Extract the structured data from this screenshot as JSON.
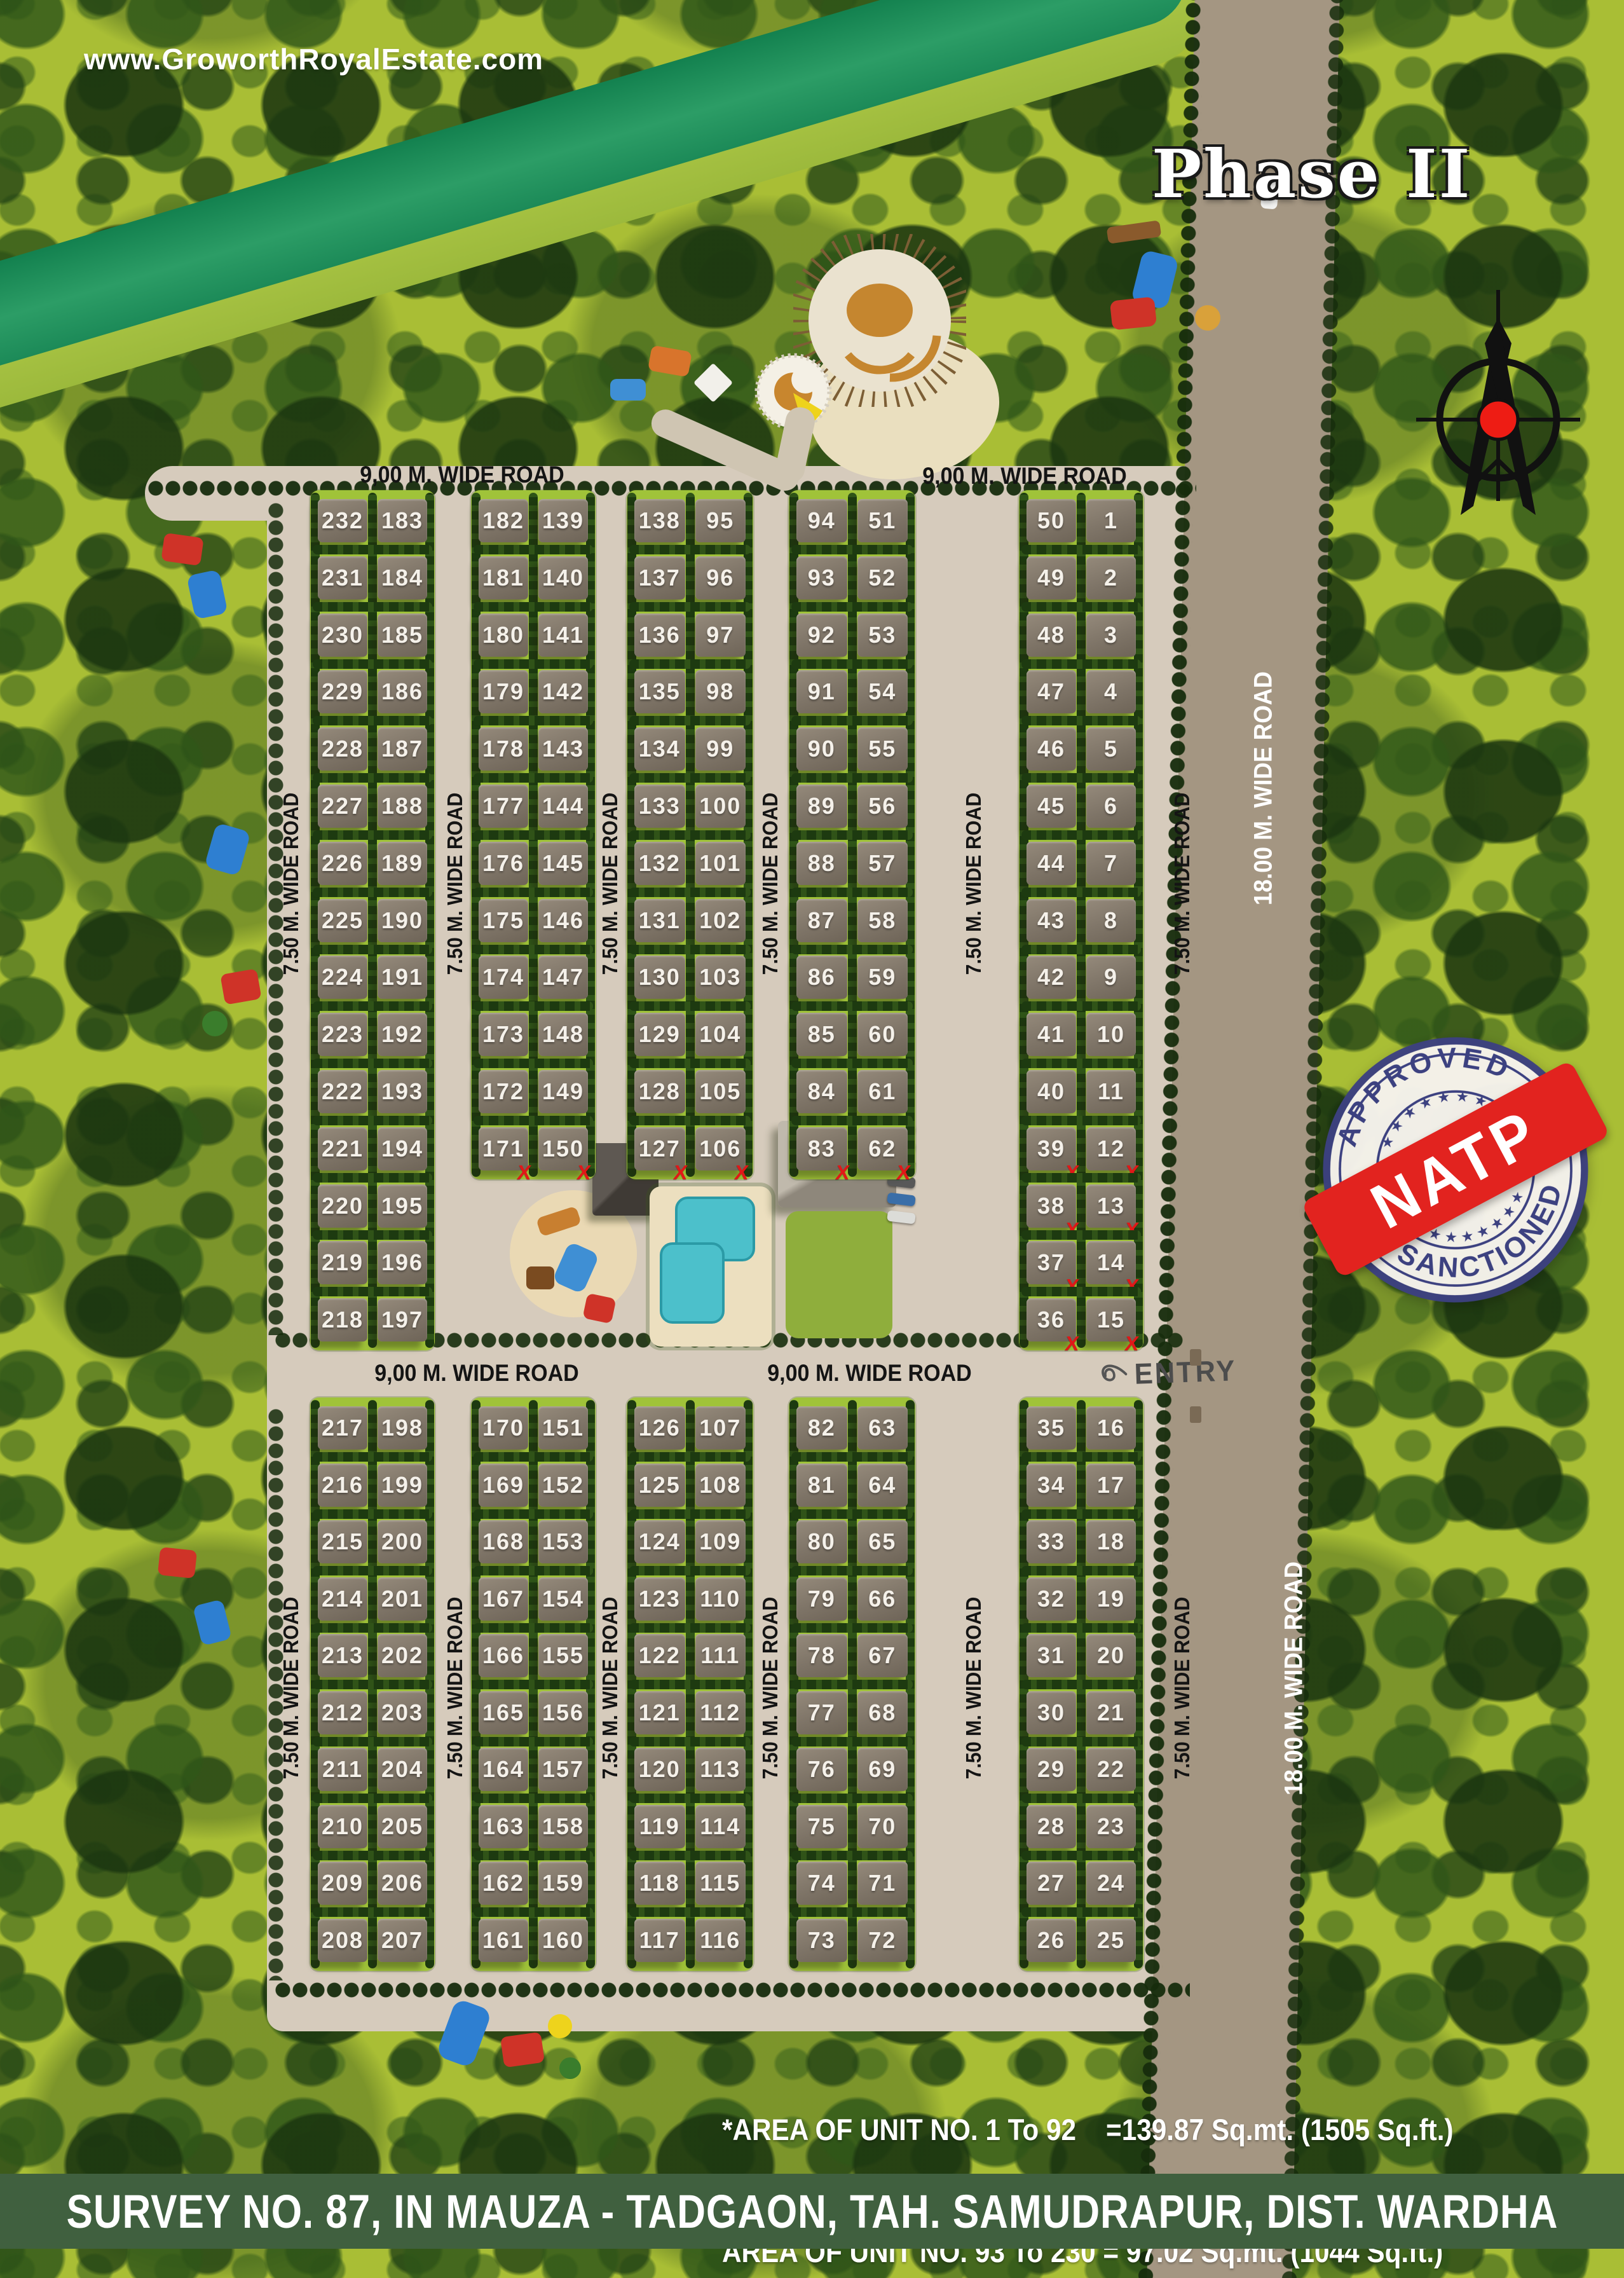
{
  "site": {
    "url": "www.GroworthRoyalEstate.com",
    "phase_title": "Phase II",
    "entry_label": "ENTRY"
  },
  "roads": {
    "w900": "9,00 M. WIDE ROAD",
    "w750": "7.50 M. WIDE ROAD",
    "w1800": "18.00 M. WIDE ROAD"
  },
  "stamp": {
    "top": "APPROVED",
    "bottom": "SANCTIONED",
    "ribbon": "NATP",
    "stars_top": "★ ★ ★ ★ ★ ★ ★",
    "stars_bottom": "★ ★ ★ ★ ★ ★ ★",
    "ring_color": "#3c4180",
    "ribbon_color": "#e2231f"
  },
  "notes": {
    "line1": "*AREA OF UNIT NO. 1 To 92    =139.87 Sq.mt. (1505 Sq.ft.)",
    "line2": "AREA OF UNIT NO. 93 To 230 = 97.02 Sq.mt. (1044 Sq.ft.)"
  },
  "footer": "SURVEY NO. 87, IN MAUZA - TADGAON, TAH. SAMUDRAPUR, DIST. WARDHA",
  "layout": {
    "sold": [
      "171",
      "150",
      "127",
      "106",
      "83",
      "62",
      "39",
      "12",
      "38",
      "13",
      "37",
      "14",
      "36",
      "15"
    ],
    "blocks": [
      {
        "id": "U1",
        "section": "upper",
        "col": 0,
        "rows": [
          [
            "232",
            "183"
          ],
          [
            "231",
            "184"
          ],
          [
            "230",
            "185"
          ],
          [
            "229",
            "186"
          ],
          [
            "228",
            "187"
          ],
          [
            "227",
            "188"
          ],
          [
            "226",
            "189"
          ],
          [
            "225",
            "190"
          ],
          [
            "224",
            "191"
          ],
          [
            "223",
            "192"
          ],
          [
            "222",
            "193"
          ],
          [
            "221",
            "194"
          ],
          [
            "220",
            "195"
          ],
          [
            "219",
            "196"
          ],
          [
            "218",
            "197"
          ]
        ]
      },
      {
        "id": "U2",
        "section": "upper",
        "col": 1,
        "rows": [
          [
            "182",
            "139"
          ],
          [
            "181",
            "140"
          ],
          [
            "180",
            "141"
          ],
          [
            "179",
            "142"
          ],
          [
            "178",
            "143"
          ],
          [
            "177",
            "144"
          ],
          [
            "176",
            "145"
          ],
          [
            "175",
            "146"
          ],
          [
            "174",
            "147"
          ],
          [
            "173",
            "148"
          ],
          [
            "172",
            "149"
          ],
          [
            "171",
            "150"
          ]
        ]
      },
      {
        "id": "U3",
        "section": "upper",
        "col": 2,
        "rows": [
          [
            "138",
            "95"
          ],
          [
            "137",
            "96"
          ],
          [
            "136",
            "97"
          ],
          [
            "135",
            "98"
          ],
          [
            "134",
            "99"
          ],
          [
            "133",
            "100"
          ],
          [
            "132",
            "101"
          ],
          [
            "131",
            "102"
          ],
          [
            "130",
            "103"
          ],
          [
            "129",
            "104"
          ],
          [
            "128",
            "105"
          ],
          [
            "127",
            "106"
          ]
        ]
      },
      {
        "id": "U4",
        "section": "upper",
        "col": 3,
        "rows": [
          [
            "94",
            "51"
          ],
          [
            "93",
            "52"
          ],
          [
            "92",
            "53"
          ],
          [
            "91",
            "54"
          ],
          [
            "90",
            "55"
          ],
          [
            "89",
            "56"
          ],
          [
            "88",
            "57"
          ],
          [
            "87",
            "58"
          ],
          [
            "86",
            "59"
          ],
          [
            "85",
            "60"
          ],
          [
            "84",
            "61"
          ],
          [
            "83",
            "62"
          ]
        ]
      },
      {
        "id": "U5",
        "section": "upper",
        "col": 4,
        "rows": [
          [
            "50",
            "1"
          ],
          [
            "49",
            "2"
          ],
          [
            "48",
            "3"
          ],
          [
            "47",
            "4"
          ],
          [
            "46",
            "5"
          ],
          [
            "45",
            "6"
          ],
          [
            "44",
            "7"
          ],
          [
            "43",
            "8"
          ],
          [
            "42",
            "9"
          ],
          [
            "41",
            "10"
          ],
          [
            "40",
            "11"
          ],
          [
            "39",
            "12"
          ],
          [
            "38",
            "13"
          ],
          [
            "37",
            "14"
          ],
          [
            "36",
            "15"
          ]
        ]
      },
      {
        "id": "L1",
        "section": "lower",
        "col": 0,
        "rows": [
          [
            "217",
            "198"
          ],
          [
            "216",
            "199"
          ],
          [
            "215",
            "200"
          ],
          [
            "214",
            "201"
          ],
          [
            "213",
            "202"
          ],
          [
            "212",
            "203"
          ],
          [
            "211",
            "204"
          ],
          [
            "210",
            "205"
          ],
          [
            "209",
            "206"
          ],
          [
            "208",
            "207"
          ]
        ]
      },
      {
        "id": "L2",
        "section": "lower",
        "col": 1,
        "rows": [
          [
            "170",
            "151"
          ],
          [
            "169",
            "152"
          ],
          [
            "168",
            "153"
          ],
          [
            "167",
            "154"
          ],
          [
            "166",
            "155"
          ],
          [
            "165",
            "156"
          ],
          [
            "164",
            "157"
          ],
          [
            "163",
            "158"
          ],
          [
            "162",
            "159"
          ],
          [
            "161",
            "160"
          ]
        ]
      },
      {
        "id": "L3",
        "section": "lower",
        "col": 2,
        "rows": [
          [
            "126",
            "107"
          ],
          [
            "125",
            "108"
          ],
          [
            "124",
            "109"
          ],
          [
            "123",
            "110"
          ],
          [
            "122",
            "111"
          ],
          [
            "121",
            "112"
          ],
          [
            "120",
            "113"
          ],
          [
            "119",
            "114"
          ],
          [
            "118",
            "115"
          ],
          [
            "117",
            "116"
          ]
        ]
      },
      {
        "id": "L4",
        "section": "lower",
        "col": 3,
        "rows": [
          [
            "82",
            "63"
          ],
          [
            "81",
            "64"
          ],
          [
            "80",
            "65"
          ],
          [
            "79",
            "66"
          ],
          [
            "78",
            "67"
          ],
          [
            "77",
            "68"
          ],
          [
            "76",
            "69"
          ],
          [
            "75",
            "70"
          ],
          [
            "74",
            "71"
          ],
          [
            "73",
            "72"
          ]
        ]
      },
      {
        "id": "L5",
        "section": "lower",
        "col": 4,
        "rows": [
          [
            "35",
            "16"
          ],
          [
            "34",
            "17"
          ],
          [
            "33",
            "18"
          ],
          [
            "32",
            "19"
          ],
          [
            "31",
            "20"
          ],
          [
            "30",
            "21"
          ],
          [
            "29",
            "22"
          ],
          [
            "28",
            "23"
          ],
          [
            "27",
            "24"
          ],
          [
            "26",
            "25"
          ]
        ]
      }
    ]
  }
}
